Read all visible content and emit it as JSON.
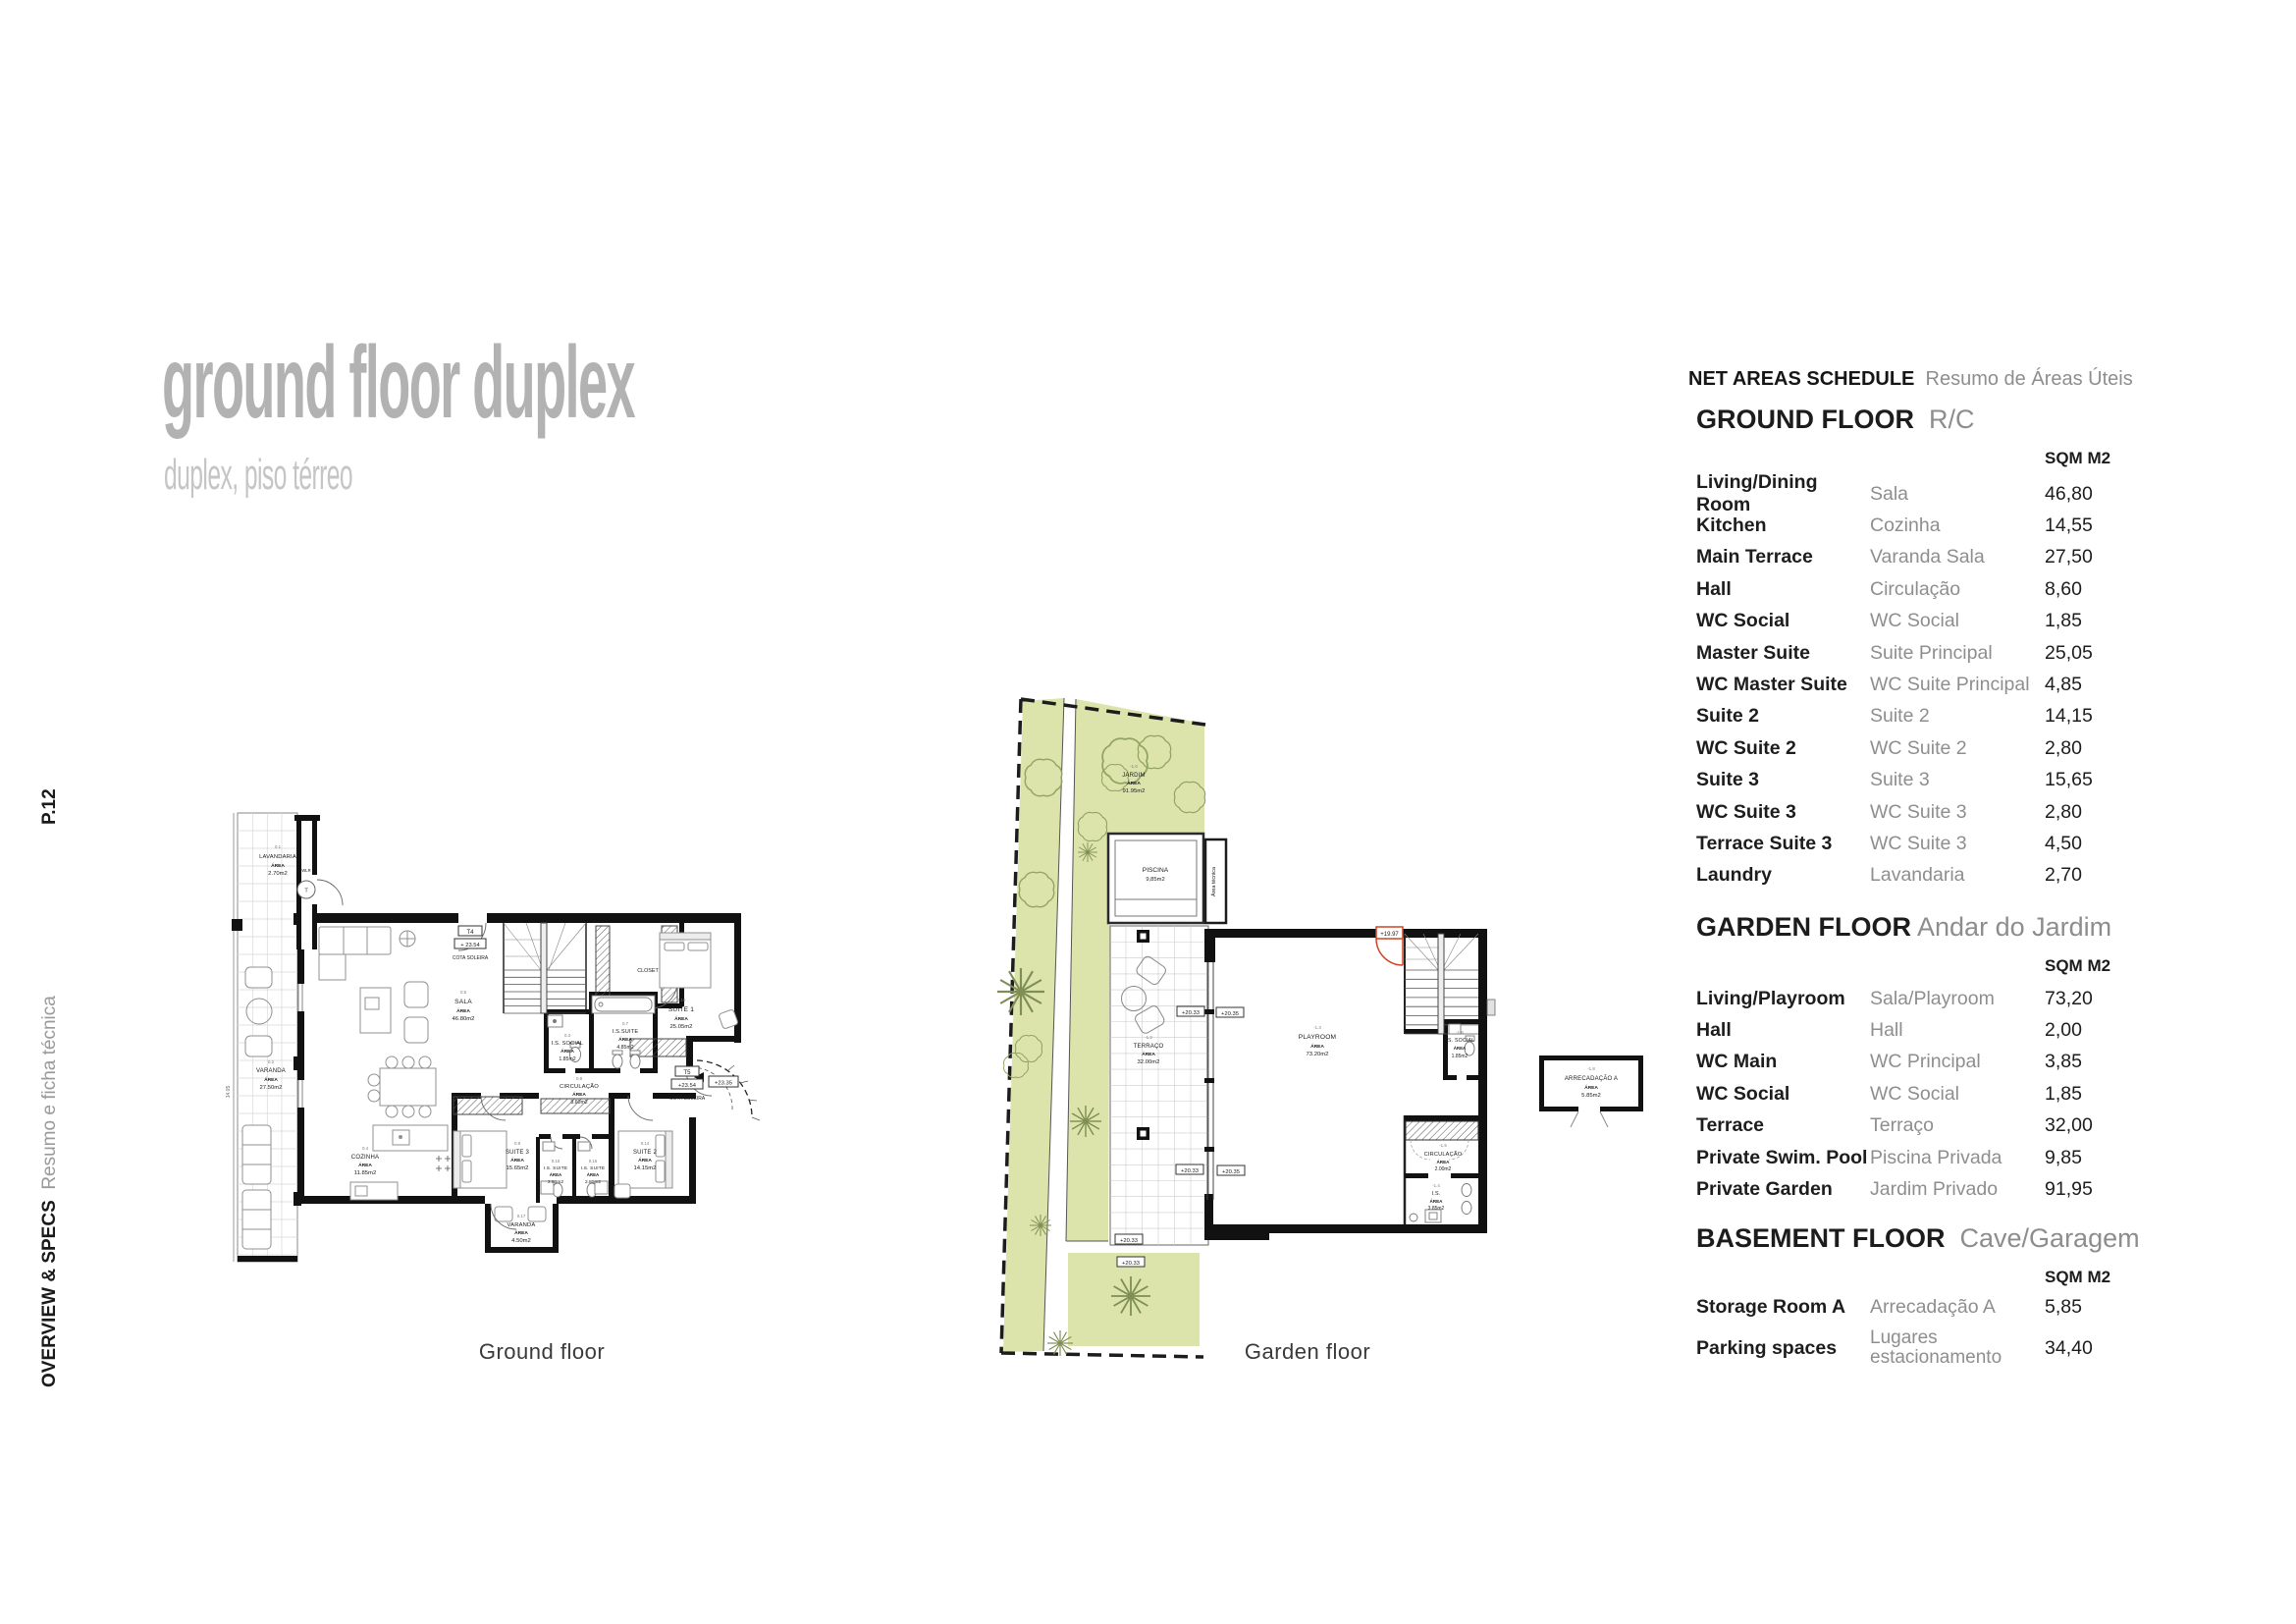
{
  "page": {
    "code": "P.12",
    "sidebar": {
      "bold": "OVERVIEW & SPECS",
      "light": "Resumo e ficha técnica"
    }
  },
  "title": {
    "main": "ground floor duplex",
    "subtitle": "duplex, piso térreo"
  },
  "schedule": {
    "title": "NET AREAS SCHEDULE",
    "title_pt": "Resumo de Áreas Úteis",
    "unit": "SQM M2",
    "sections": [
      {
        "name": "GROUND FLOOR",
        "name_pt": "R/C",
        "rows": [
          {
            "en": "Living/Dining Room",
            "pt": "Sala",
            "sqm": "46,80"
          },
          {
            "en": "Kitchen",
            "pt": "Cozinha",
            "sqm": "14,55"
          },
          {
            "en": "Main Terrace",
            "pt": "Varanda Sala",
            "sqm": "27,50"
          },
          {
            "en": "Hall",
            "pt": "Circulação",
            "sqm": "8,60"
          },
          {
            "en": "WC Social",
            "pt": "WC Social",
            "sqm": "1,85"
          },
          {
            "en": "Master Suite",
            "pt": "Suite Principal",
            "sqm": "25,05"
          },
          {
            "en": "WC Master Suite",
            "pt": "WC Suite Principal",
            "sqm": "4,85"
          },
          {
            "en": "Suite 2",
            "pt": "Suite 2",
            "sqm": "14,15"
          },
          {
            "en": "WC Suite 2",
            "pt": "WC Suite 2",
            "sqm": "2,80"
          },
          {
            "en": "Suite 3",
            "pt": "Suite 3",
            "sqm": "15,65"
          },
          {
            "en": "WC Suite 3",
            "pt": "WC Suite 3",
            "sqm": "2,80"
          },
          {
            "en": "Terrace Suite 3",
            "pt": "WC Suite 3",
            "sqm": "4,50"
          },
          {
            "en": "Laundry",
            "pt": "Lavandaria",
            "sqm": "2,70"
          }
        ]
      },
      {
        "name": "GARDEN FLOOR",
        "name_pt": "Andar do Jardim",
        "rows": [
          {
            "en": "Living/Playroom",
            "pt": "Sala/Playroom",
            "sqm": "73,20"
          },
          {
            "en": "Hall",
            "pt": "Hall",
            "sqm": "2,00"
          },
          {
            "en": "WC Main",
            "pt": "WC Principal",
            "sqm": "3,85"
          },
          {
            "en": "WC Social",
            "pt": "WC Social",
            "sqm": "1,85"
          },
          {
            "en": "Terrace",
            "pt": "Terraço",
            "sqm": "32,00"
          },
          {
            "en": "Private Swim. Pool",
            "pt": "Piscina Privada",
            "sqm": "9,85"
          },
          {
            "en": "Private Garden",
            "pt": "Jardim Privado",
            "sqm": "91,95"
          }
        ]
      },
      {
        "name": "BASEMENT FLOOR",
        "name_pt": "Cave/Garagem",
        "rows": [
          {
            "en": "Storage Room A",
            "pt": "Arrecadação A",
            "sqm": "5,85"
          },
          {
            "en": "Parking spaces",
            "pt": "Lugares estacionamento",
            "sqm": "34,40"
          }
        ]
      }
    ]
  },
  "plans": {
    "area_word": "ÁREA",
    "ground": {
      "caption": "Ground floor",
      "dim": "14.05",
      "wlr": "WLR",
      "boiler": "T",
      "t4": {
        "code": "T4",
        "level": "+ 23.54",
        "label": "COTA SOLEIRA"
      },
      "t5": {
        "code": "T5",
        "level": "+23.54",
        "label": "COTA SOLEIRA",
        "level2": "+23.35"
      },
      "rooms": {
        "lavandaria": {
          "tag": "0.1",
          "name": "LAVANDARIA",
          "area": "2.70m2"
        },
        "varanda": {
          "tag": "0.2",
          "name": "VARANDA",
          "area": "27.50m2"
        },
        "sala": {
          "tag": "0.5",
          "name": "SALA",
          "area": "46.80m2"
        },
        "closet": {
          "name": "CLOSET"
        },
        "suite1": {
          "tag": "0.10",
          "name": "SUITE 1",
          "area": "25.05m2"
        },
        "is_social": {
          "tag": "0.3",
          "name": "I.S. SOCIAL",
          "area": "1.85m2"
        },
        "is_suite": {
          "tag": "0.7",
          "name": "I.S.SUITE",
          "area": "4.85m2"
        },
        "circulacao": {
          "tag": "0.8",
          "name": "CIRCULAÇÃO",
          "area": "8.60m2"
        },
        "cozinha": {
          "tag": "0.4",
          "name": "COZINHA",
          "area": "11.85m2"
        },
        "suite3": {
          "tag": "0.9",
          "name": "SUITE 3",
          "area": "15.65m2"
        },
        "is_suite3a": {
          "tag": "0.15",
          "name": "I.S. SUITE",
          "area": "2.80m2"
        },
        "is_suite3b": {
          "tag": "0.16",
          "name": "I.S. SUITE",
          "area": "2.80m2"
        },
        "suite2": {
          "tag": "0.14",
          "name": "SUITE 2",
          "area": "14.15m2"
        },
        "varanda2": {
          "tag": "0.17",
          "name": "VARANDA",
          "area": "4.50m2"
        }
      }
    },
    "garden": {
      "caption": "Garden floor",
      "tecnica": "Área técnica",
      "door_level": "+19.97",
      "markers": [
        "+20.33",
        "+20.35",
        "+20.33",
        "+20.35",
        "+20.33",
        "+20.33"
      ],
      "rooms": {
        "jardim": {
          "tag": "-1.0",
          "name": "JARDIM",
          "area": "91.95m2"
        },
        "piscina": {
          "name": "PISCINA",
          "area": "9,85m2"
        },
        "terraco": {
          "tag": "-1.2",
          "name": "TERRAÇO",
          "area": "32.00m2"
        },
        "playroom": {
          "tag": "-1.3",
          "name": "PLAYROOM",
          "area": "73.20m2"
        },
        "is_social": {
          "tag": "-1.6",
          "name": "I.S. SOCIAL",
          "area": "1.85m2"
        },
        "circulacao": {
          "tag": "-1.5",
          "name": "CIRCULAÇÃO",
          "area": "2.00m2"
        },
        "is": {
          "tag": "-1.4",
          "name": "I.S.",
          "area": "3.85m2"
        }
      }
    },
    "storage": {
      "tag": "-1.8",
      "name": "ARRECADAÇÃO A",
      "area": "5.85m2"
    }
  }
}
